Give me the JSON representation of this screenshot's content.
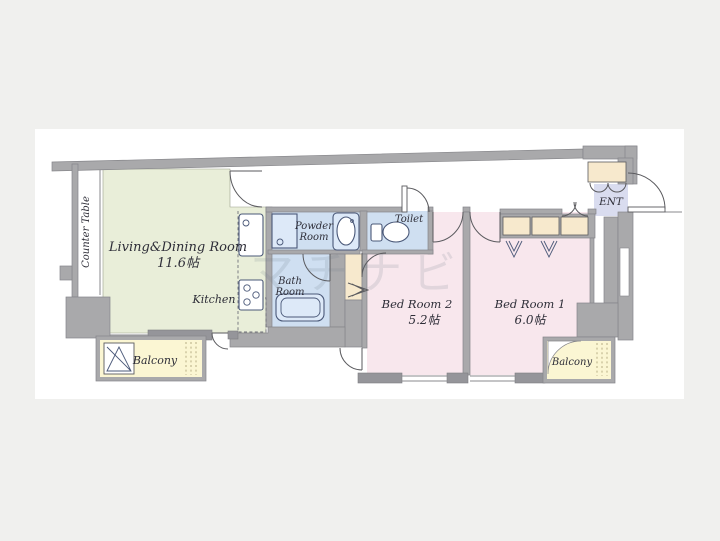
{
  "page": {
    "background": "#f0f0ee",
    "sheet_background": "#ffffff"
  },
  "watermark": "マチナビ",
  "colors": {
    "living": "#e9eed9",
    "bedroom": "#f8e7ed",
    "wet_area": "#cfdff1",
    "balcony": "#fbf6d3",
    "closet": "#f7e9cd",
    "entrance": "#d9dcef",
    "wall": "#a9a9ab"
  },
  "rooms": {
    "living": {
      "name": "Living&Dining Room",
      "size": "11.6帖"
    },
    "kitchen": {
      "name": "Kitchen"
    },
    "counter": {
      "name": "Counter Table"
    },
    "powder": {
      "line1": "Powder",
      "line2": "Room"
    },
    "bath": {
      "line1": "Bath",
      "line2": "Room"
    },
    "toilet": {
      "name": "Toilet"
    },
    "bedroom2": {
      "name": "Bed Room 2",
      "size": "5.2帖"
    },
    "bedroom1": {
      "name": "Bed Room 1",
      "size": "6.0帖"
    },
    "balcony_left": {
      "name": "Balcony"
    },
    "balcony_right": {
      "name": "Balcony"
    },
    "entrance": {
      "name": "ENT"
    }
  }
}
